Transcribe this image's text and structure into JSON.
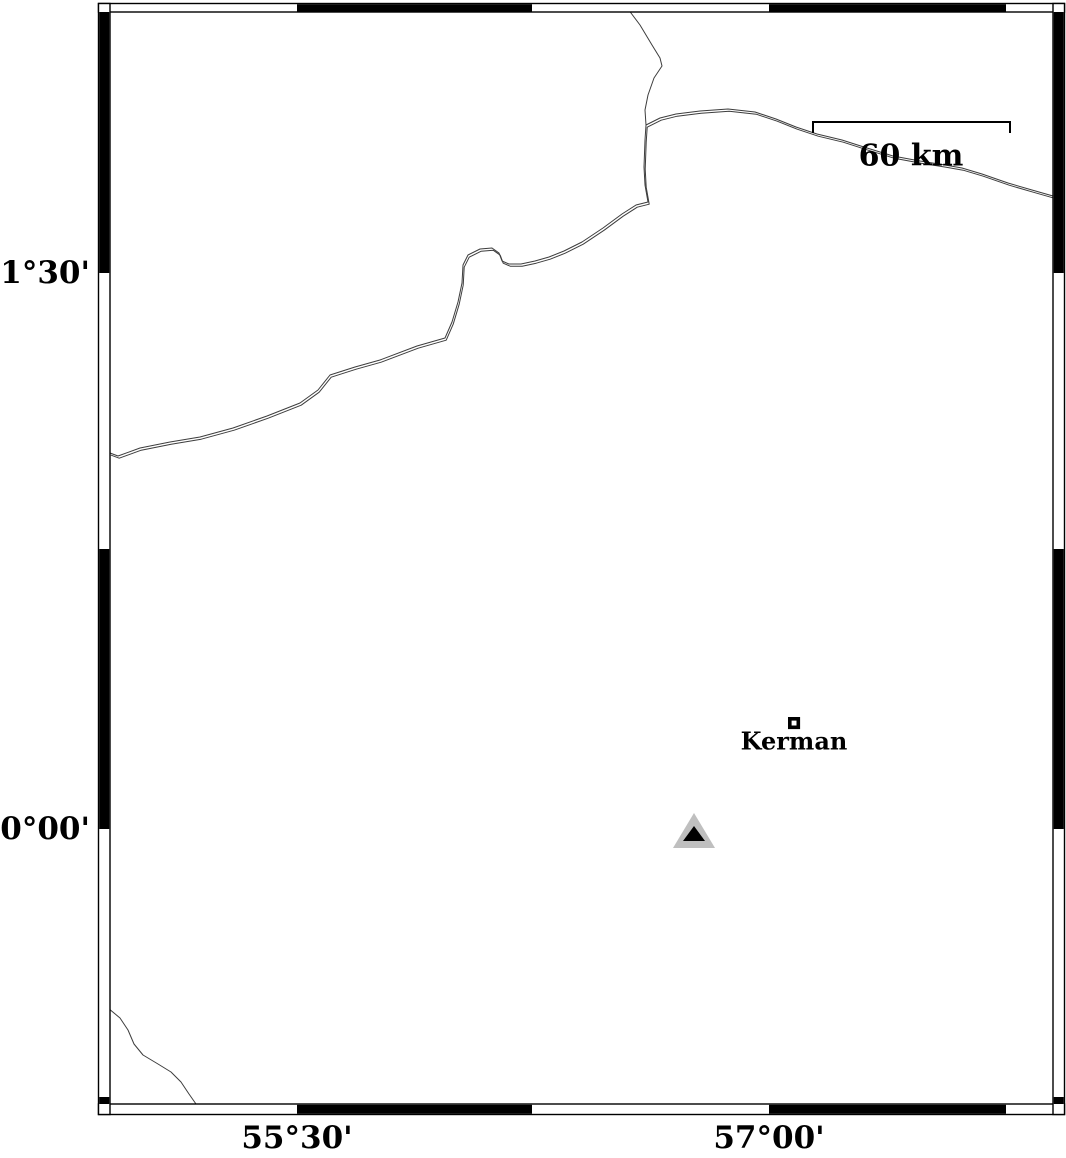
{
  "figure": {
    "type": "geographic-map",
    "background": "#ffffff",
    "frame_color": "#000000",
    "line_color": "#3d3d3d"
  },
  "labels": {
    "lat": [
      {
        "text": "31°30'",
        "y": 273
      },
      {
        "text": "30°00'",
        "y": 829
      }
    ],
    "lon": [
      {
        "text": "55°30'",
        "x": 297
      },
      {
        "text": "57°00'",
        "x": 769
      }
    ]
  },
  "scale_bar": {
    "label": "60 km",
    "length_km": 60
  },
  "city": {
    "name": "Kerman",
    "symbol": "open-square"
  },
  "station": {
    "symbol": "triangle",
    "outer_color": "#bfbfbf",
    "inner_color": "#000000"
  },
  "features": {
    "main_road": "M 110 453 L 118 456 L 140 448 L 170 442 L 200 437 L 233 428 L 267 416 L 300 403 L 318 390 L 330 375 L 355 367 L 380 360 L 417 346 L 445 338 L 452 322 L 458 302 L 462 283 L 463 265 L 468 255 L 480 249 L 492 248 L 499 253 L 502 261 L 509 264 L 521 264 L 535 261 L 549 257 L 564 251 L 582 242 L 603 228 L 622 214 L 636 205 L 648 202 L 645 185 L 644 167 L 645 140 L 646 125 L 660 118 L 676 114 L 700 111 L 728 109 L 755 112 L 776 119 L 796 127 L 817 134 L 842 140 L 867 148 L 893 156 L 920 161 L 945 165 L 962 168 L 982 174 L 1008 183 L 1032 190 L 1053 196",
    "top_branch_road": "M 628 9 L 640 25 L 652 45 L 660 58 L 662 66 L 654 78 L 648 95 L 645 110 L 646 125",
    "southwest_river": "M 108 1008 L 120 1018 L 128 1030 L 134 1044 L 143 1055 L 158 1064 L 171 1072 L 181 1082 L 189 1094 L 196 1104"
  }
}
